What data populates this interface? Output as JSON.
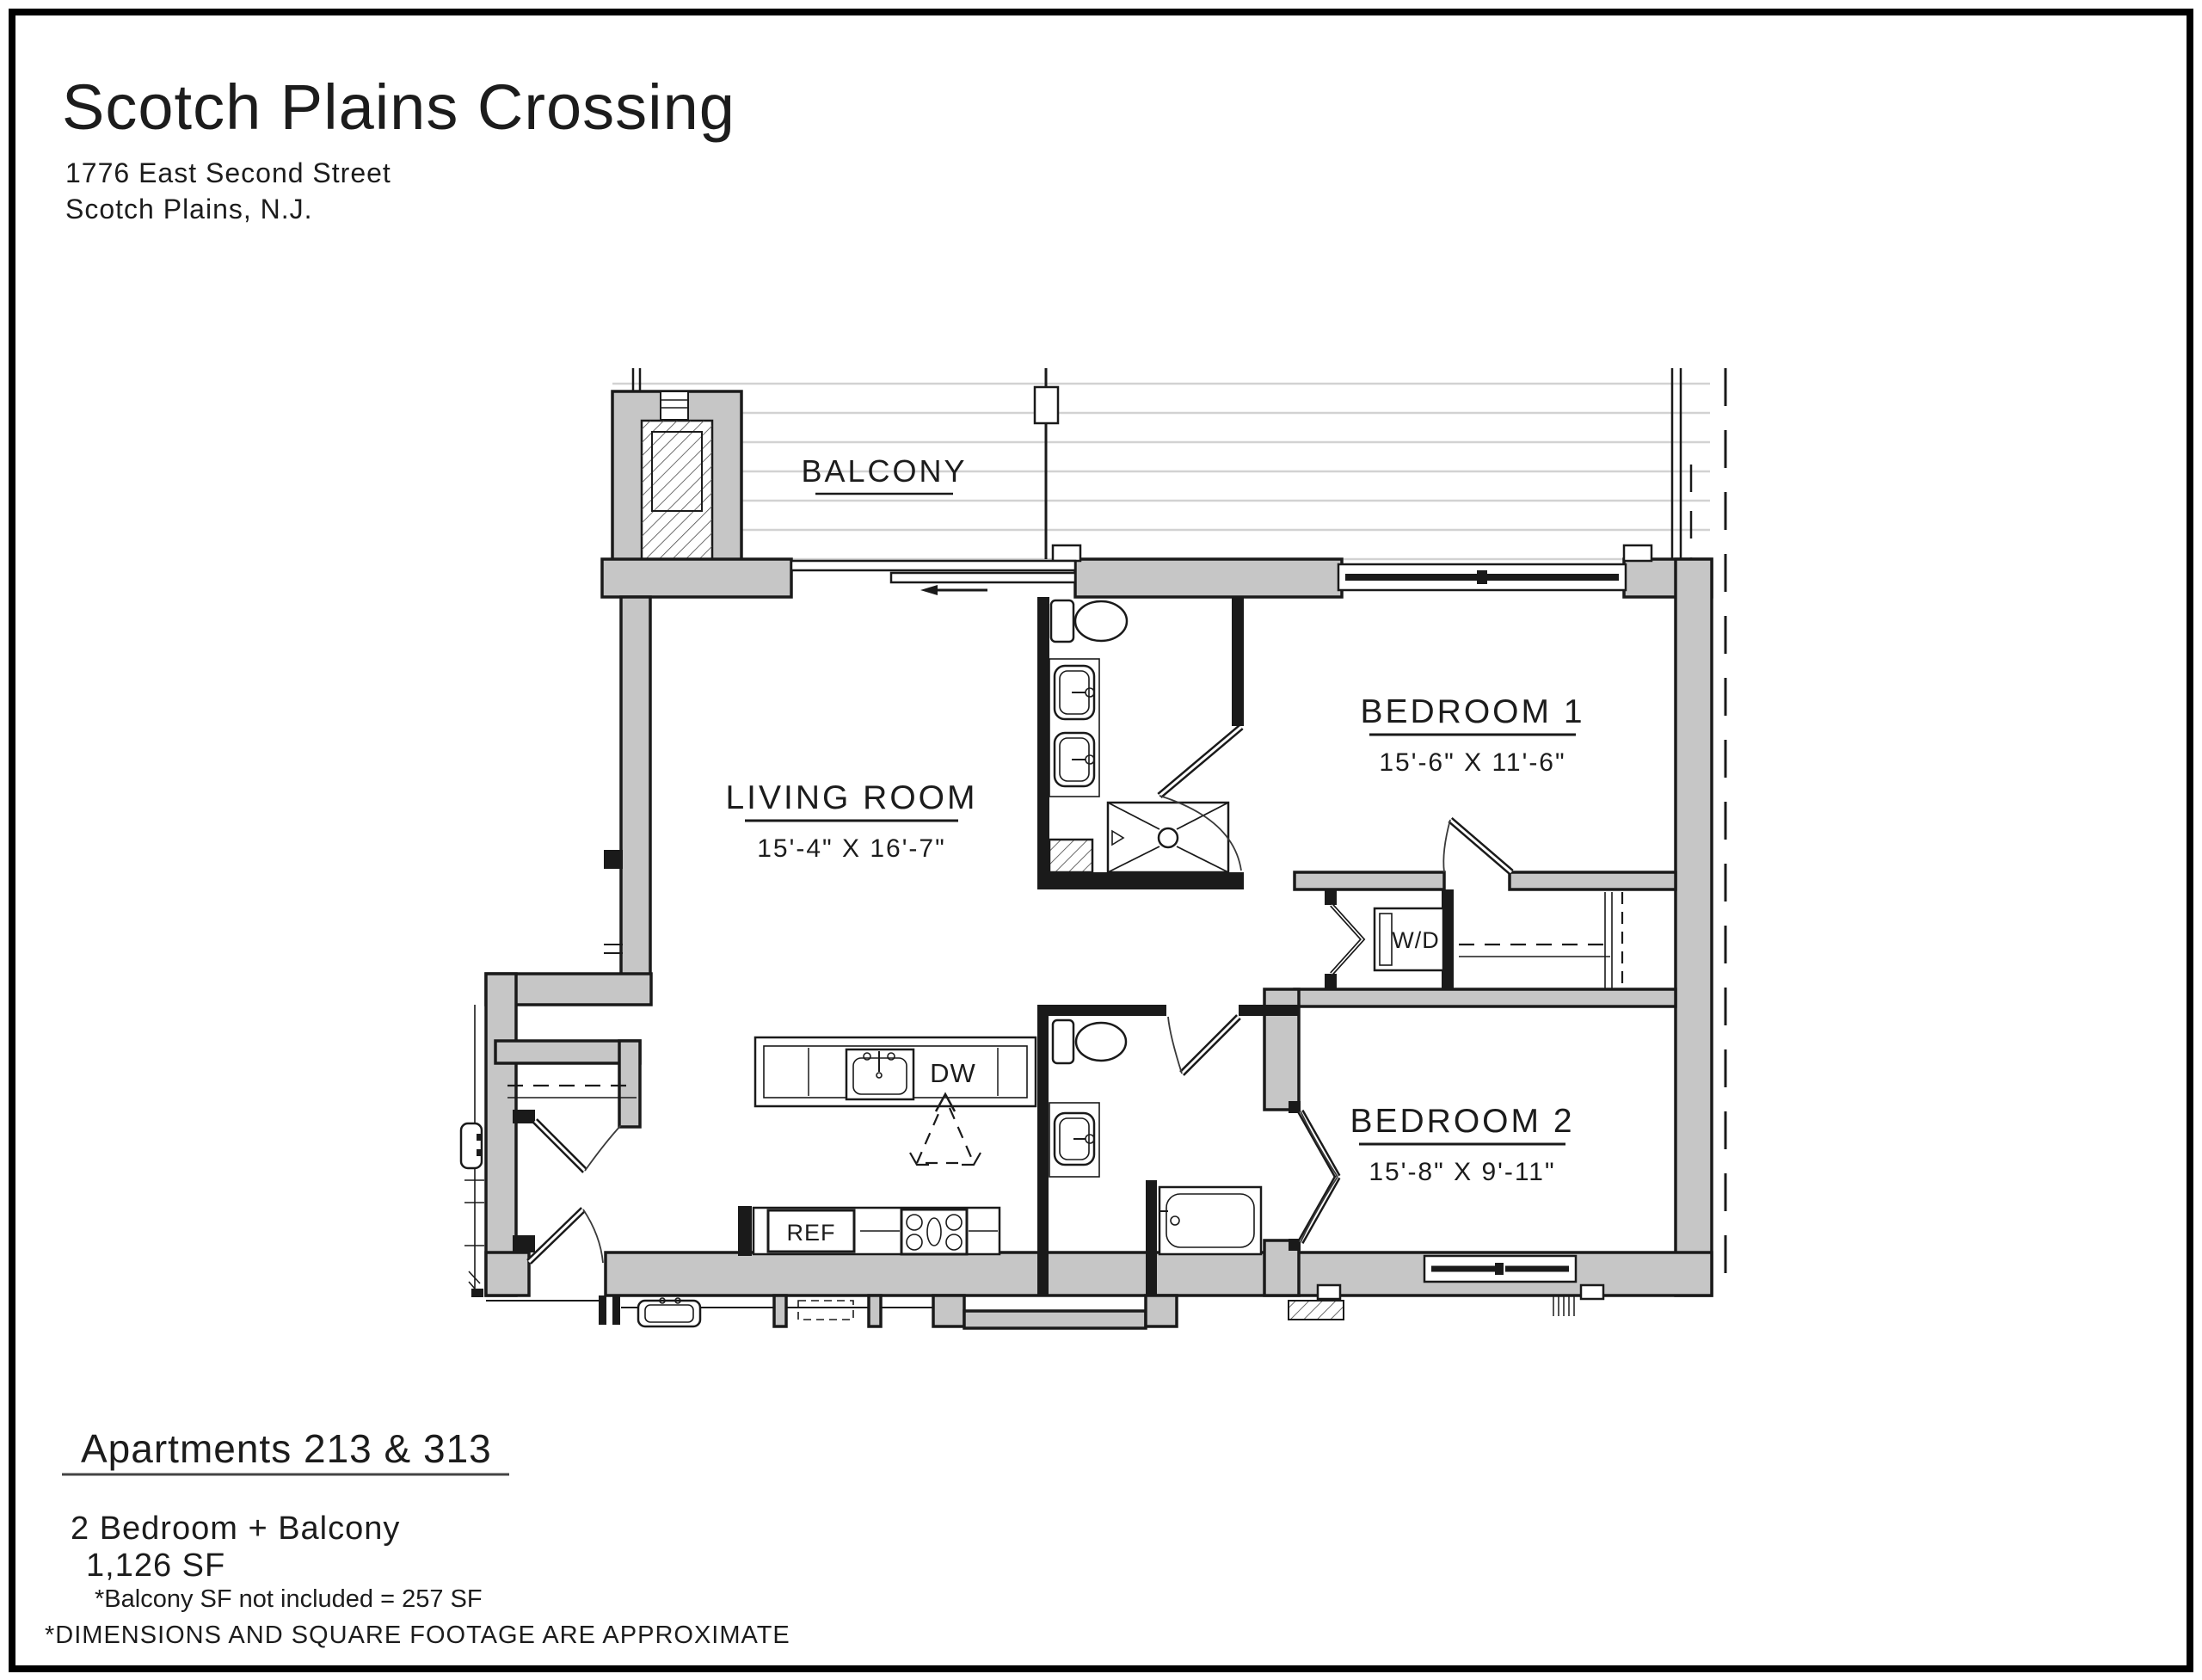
{
  "header": {
    "title": "Scotch Plains Crossing",
    "address_line1": "1776 East Second Street",
    "address_line2": "Scotch Plains, N.J."
  },
  "rooms": {
    "balcony": {
      "label": "BALCONY"
    },
    "living_room": {
      "label": "LIVING ROOM",
      "dimensions": "15'-4\" X 16'-7\""
    },
    "bedroom1": {
      "label": "BEDROOM 1",
      "dimensions": "15'-6\" X 11'-6\""
    },
    "bedroom2": {
      "label": "BEDROOM 2",
      "dimensions": "15'-8\" X 9'-11\""
    }
  },
  "appliances": {
    "washer_dryer": "W/D",
    "dishwasher": "DW",
    "refrigerator": "REF"
  },
  "footer": {
    "unit_title": "Apartments 213 & 313",
    "unit_type": "2 Bedroom + Balcony",
    "area": "1,126 SF",
    "balcony_note": "*Balcony SF not included = 257 SF",
    "disclaimer": "*DIMENSIONS AND SQUARE FOOTAGE ARE APPROXIMATE"
  },
  "colors": {
    "wall_fill": "#c6c6c6",
    "line": "#1a1a1a",
    "deck_line": "#d2d2d2"
  }
}
